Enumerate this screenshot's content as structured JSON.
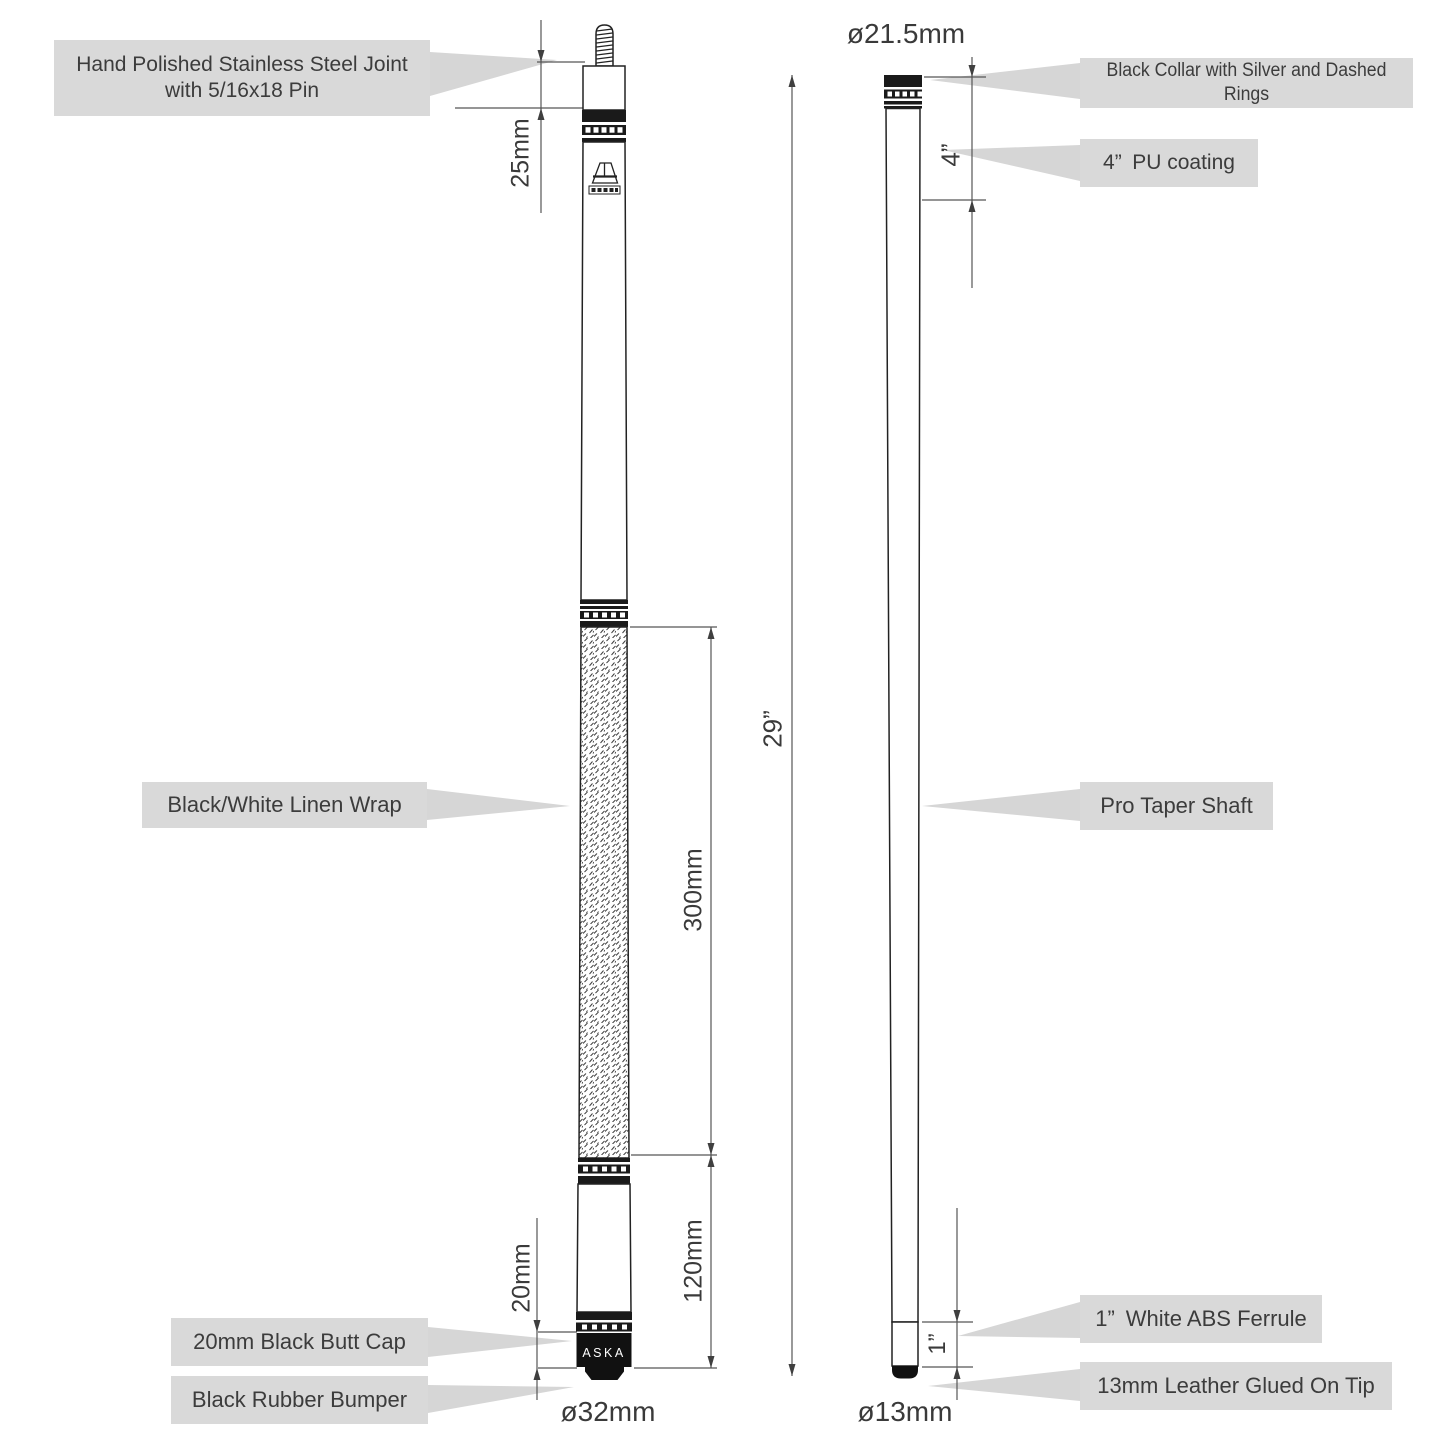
{
  "diagram": {
    "callouts": {
      "joint_line1": "Hand Polished Stainless Steel Joint",
      "joint_line2": "with 5/16x18 Pin",
      "wrap": "Black/White Linen Wrap",
      "butt_cap": "20mm Black Butt Cap",
      "bumper": "Black Rubber Bumper",
      "collar": "Black Collar with Silver and Dashed Rings",
      "pu_coating": "4” PU coating",
      "shaft": "Pro Taper Shaft",
      "ferrule": "1” White ABS Ferrule",
      "tip": "13mm Leather Glued On Tip"
    },
    "dimensions": {
      "joint_length": "25mm",
      "wrap_length": "300mm",
      "sleeve_length": "120mm",
      "butt_cap_length": "20mm",
      "butt_diameter": "ø32mm",
      "overall_length": "29”",
      "pu_length": "4”",
      "ferrule_length": "1”",
      "joint_diameter": "ø21.5mm",
      "tip_diameter": "ø13mm"
    },
    "brand": {
      "butt_cap_text": "ASKA"
    },
    "colors": {
      "callout_bg": "#d9d9d9",
      "ink": "#1f1f1f",
      "dim_line": "#565656",
      "text": "#3f3f3f"
    }
  }
}
